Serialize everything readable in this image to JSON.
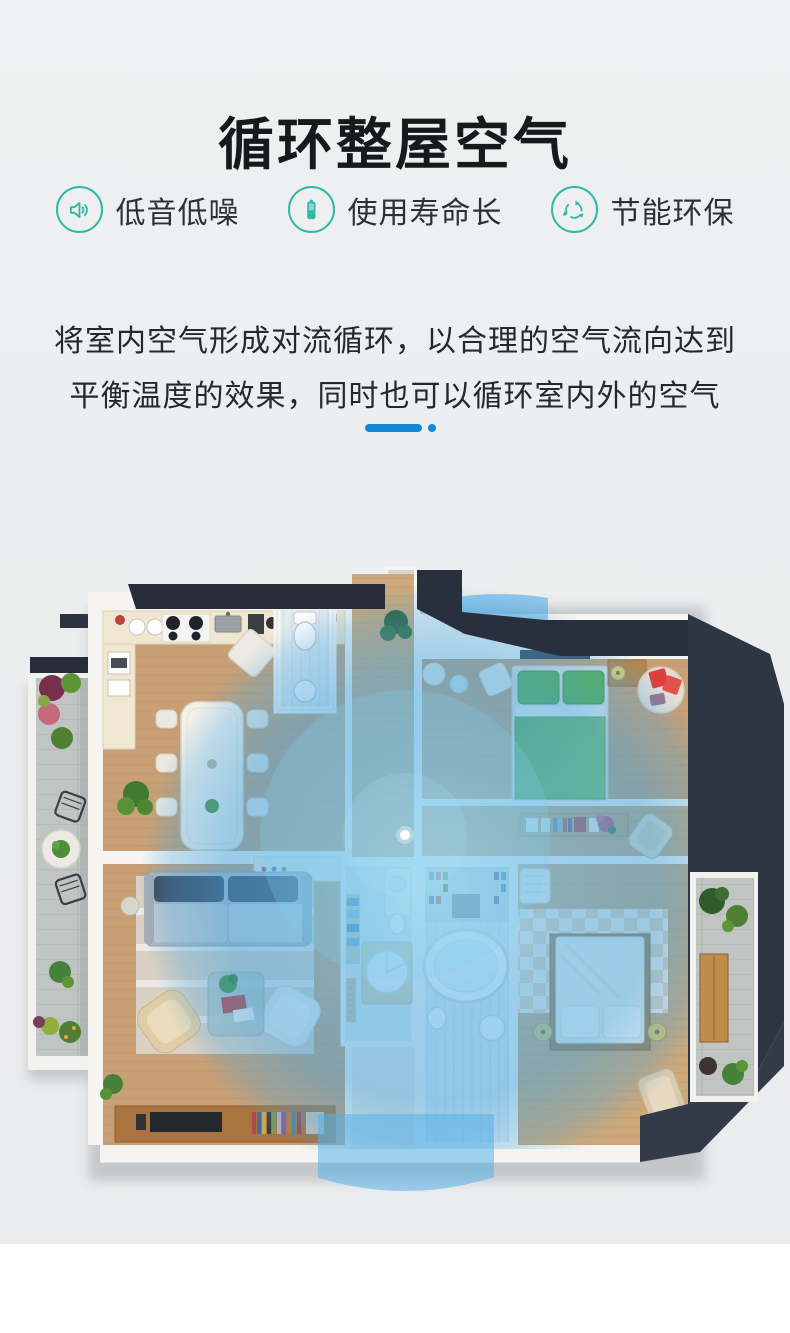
{
  "page": {
    "background_top": "#edeff0",
    "background_bottom": "#ffffff"
  },
  "header": {
    "title": "循环整屋空气"
  },
  "features": [
    {
      "icon": "speaker-icon",
      "label": "低音低噪"
    },
    {
      "icon": "battery-icon",
      "label": "使用寿命长"
    },
    {
      "icon": "recycle-icon",
      "label": "节能环保"
    }
  ],
  "description": {
    "line1": "将室内空气形成对流循环，以合理的空气流向达到",
    "line2": "平衡温度的效果，同时也可以循环室内外的空气"
  },
  "colors": {
    "accent_teal": "#2eb8a6",
    "accent_blue": "#1587d9",
    "airflow_blue": "#45a7e3",
    "roof_dark": "#2b3340",
    "wood_floor": "#c9a075",
    "text_dark": "#26282c"
  },
  "floorplan": {
    "rooms": [
      "kitchen",
      "dining-room",
      "top-bathroom",
      "hallway",
      "master-bedroom",
      "hall-closet",
      "living-room",
      "laundry-bathroom",
      "main-bathroom",
      "second-bedroom",
      "left-balcony",
      "right-terrace"
    ]
  }
}
